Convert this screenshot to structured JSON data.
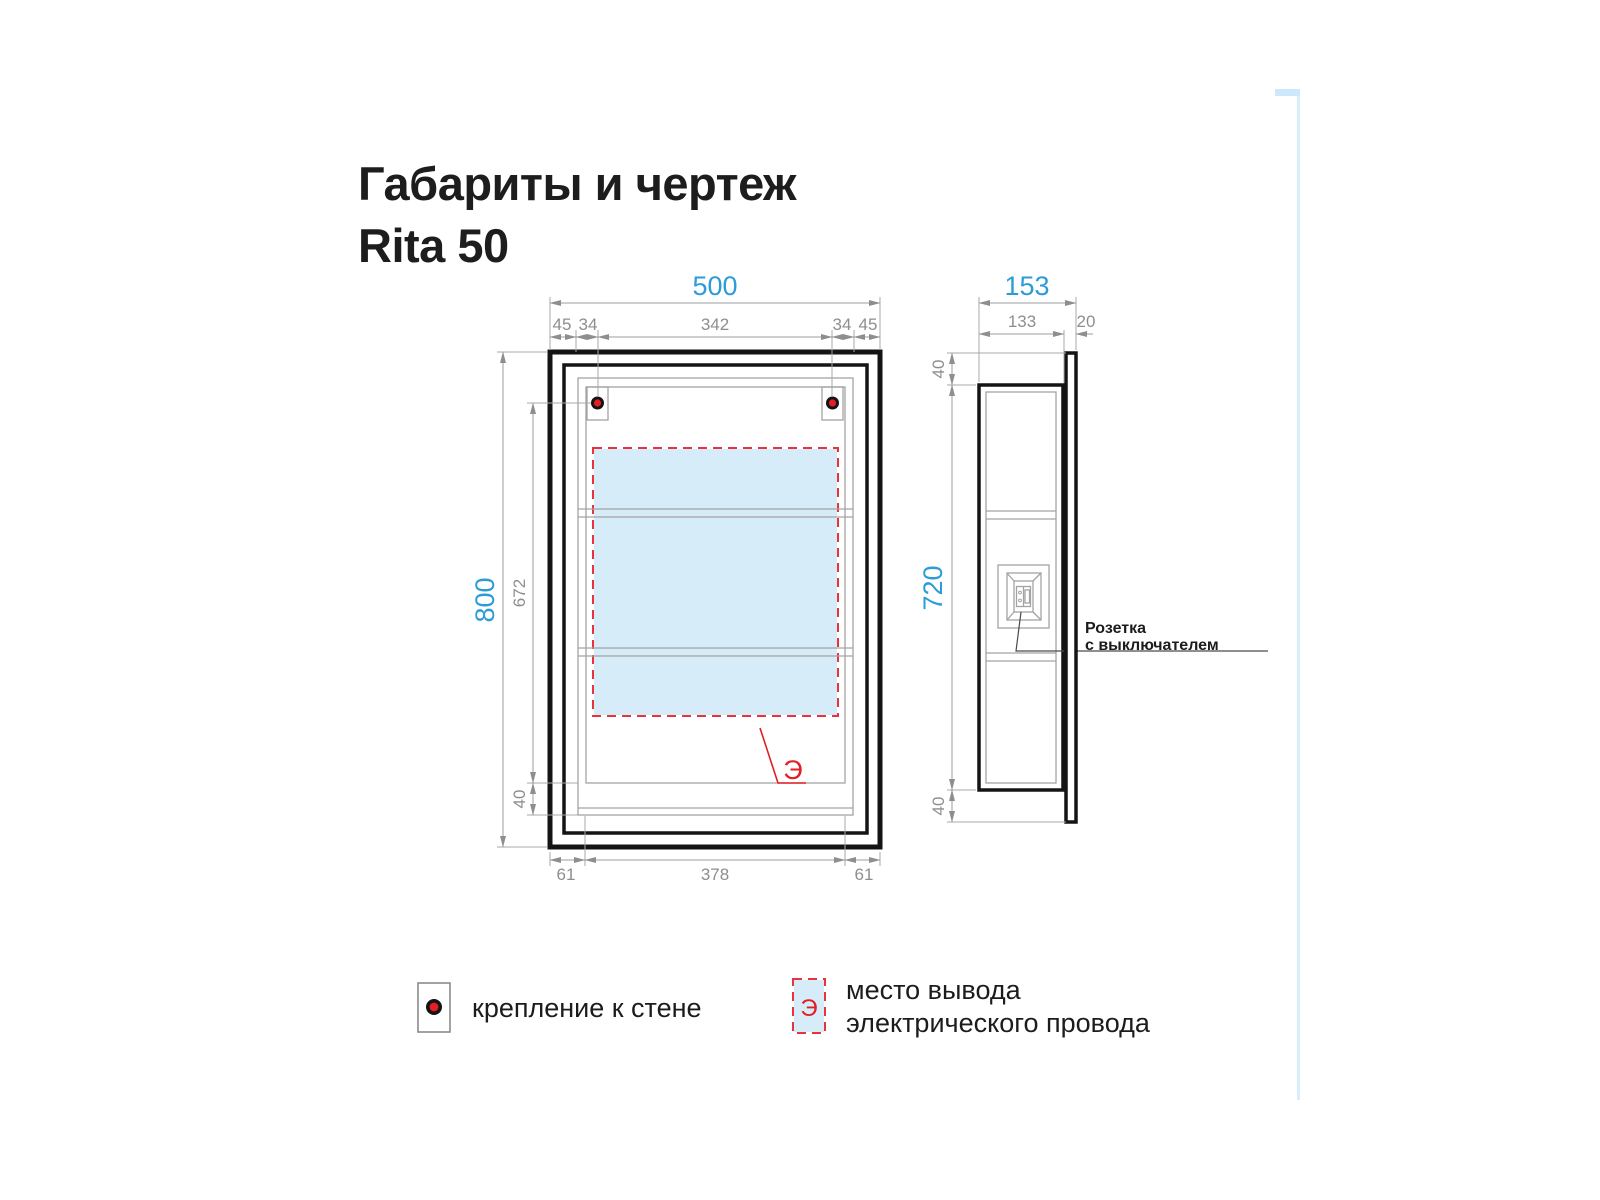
{
  "title": {
    "line1": "Габариты и чертеж",
    "line2": "Rita 50"
  },
  "front_view": {
    "width_label": "500",
    "height_label": "800",
    "top_row": [
      "45",
      "34",
      "342",
      "34",
      "45"
    ],
    "hole_to_bottom_label": "672",
    "bottom_inset_label": "40",
    "bottom_row": [
      "61",
      "378",
      "61"
    ],
    "electric_mark": "Э"
  },
  "side_view": {
    "depth_label": "153",
    "body_depth_label": "133",
    "door_thickness_label": "20",
    "top_overhang_label": "40",
    "body_height_label": "720",
    "bottom_overhang_label": "40",
    "socket_label_line1": "Розетка",
    "socket_label_line2": "с выключателем"
  },
  "legend": {
    "wall_mount_label": "крепление к стене",
    "electric_mark": "Э",
    "electric_label_line1": "место вывода",
    "electric_label_line2": "электрического провода"
  },
  "icons": {
    "wall_mount_icon": "red-dot-marker",
    "electric_area_icon": "red-dashed-area"
  },
  "colors": {
    "accent_blue": "#2b9cd8",
    "dim_gray": "#8e8e8e",
    "marker_red": "#e31e24",
    "area_fill": "#d7ecf9",
    "line_black": "#141414"
  }
}
